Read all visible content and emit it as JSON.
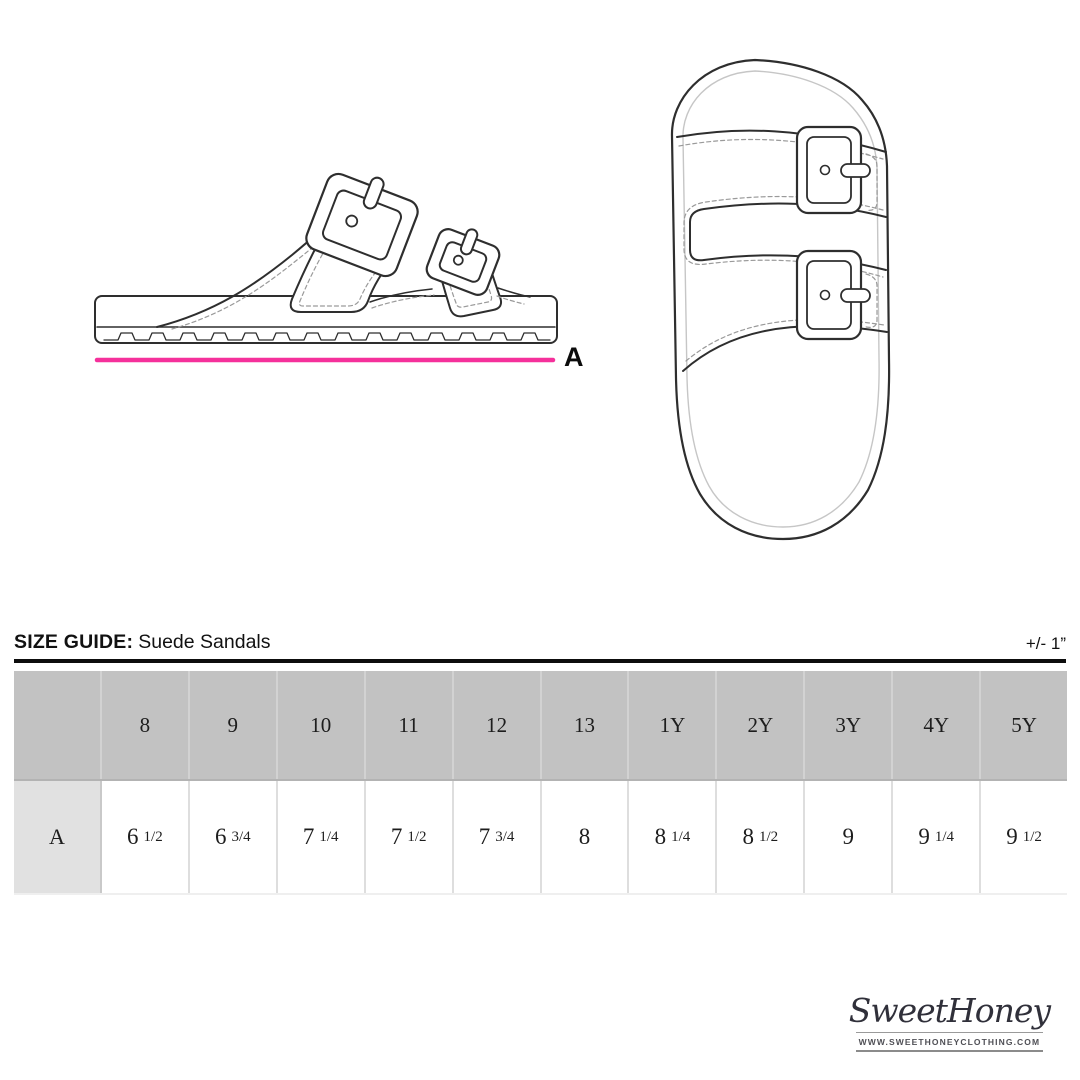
{
  "figures": {
    "measure_label": "A"
  },
  "size_guide": {
    "title_bold": "SIZE GUIDE:",
    "title_item": "Suede Sandals",
    "tolerance": "+/- 1”"
  },
  "table": {
    "columns": [
      "8",
      "9",
      "10",
      "11",
      "12",
      "13",
      "1Y",
      "2Y",
      "3Y",
      "4Y",
      "5Y"
    ],
    "row_label": "A",
    "values": [
      {
        "whole": "6",
        "frac": "1/2"
      },
      {
        "whole": "6",
        "frac": "3/4"
      },
      {
        "whole": "7",
        "frac": "1/4"
      },
      {
        "whole": "7",
        "frac": "1/2"
      },
      {
        "whole": "7",
        "frac": "3/4"
      },
      {
        "whole": "8",
        "frac": ""
      },
      {
        "whole": "8",
        "frac": "1/4"
      },
      {
        "whole": "8",
        "frac": "1/2"
      },
      {
        "whole": "9",
        "frac": ""
      },
      {
        "whole": "9",
        "frac": "1/4"
      },
      {
        "whole": "9",
        "frac": "1/2"
      }
    ]
  },
  "branding": {
    "logo_text": "SweetHoney",
    "website": "WWW.SWEETHONEYCLOTHING.COM"
  },
  "colors": {
    "accent_pink": "#f5309b",
    "table_header_bg": "#c2c2c2",
    "row_label_bg": "#e1e1e1",
    "rule_black": "#0d0d0d"
  }
}
